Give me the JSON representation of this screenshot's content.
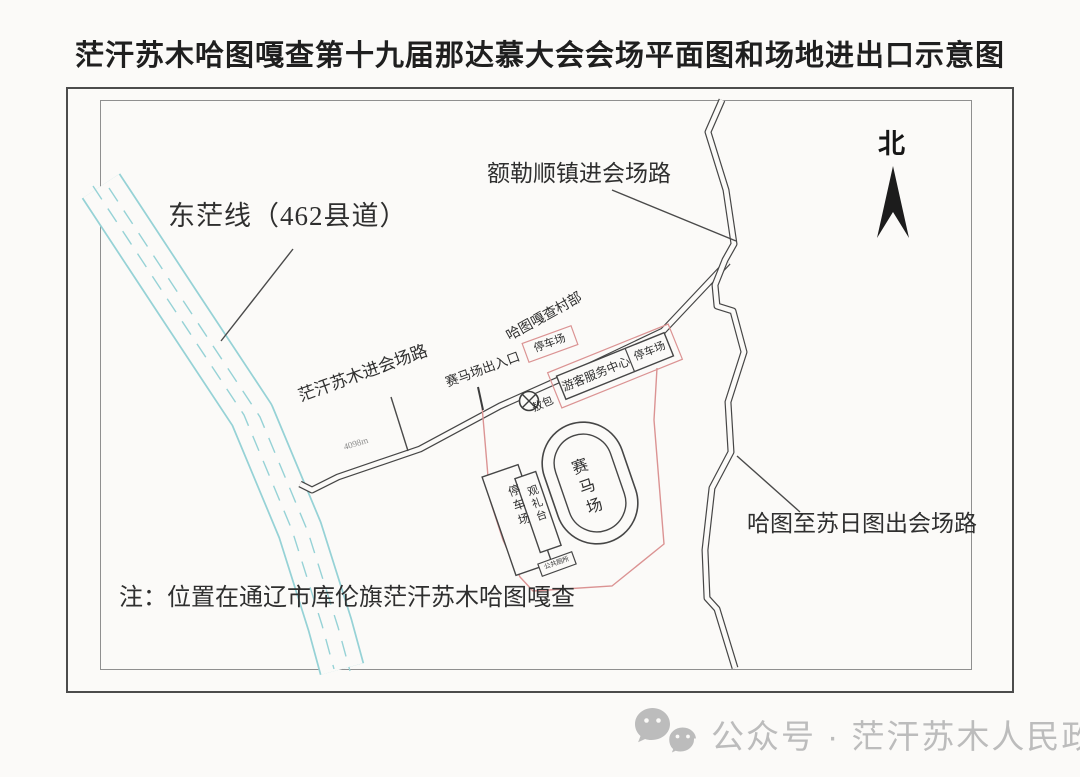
{
  "title": "茫汗苏木哈图嘎查第十九届那达慕大会会场平面图和场地进出口示意图",
  "map": {
    "north": "北",
    "roads": {
      "county_road_label": "东茫线（462县道）",
      "eleshun_entry_label": "额勒顺镇进会场路",
      "manghan_entry_label": "茫汗苏木进会场路",
      "hatu_surit_exit_label": "哈图至苏日图出会场路",
      "distance_marker": "4098m"
    },
    "venue": {
      "village_office": "哈图嘎查村部",
      "parking_north": "停车场",
      "visitor_center": "游客服务中心",
      "visitor_center_parking": "停车场",
      "racecourse_gate": "赛马场出入口",
      "aobao": "敖包",
      "racecourse": "赛马场",
      "viewing_stand": "观礼台",
      "parking_west": "停车场",
      "public_toilet": "公共厕所"
    },
    "note": "注：位置在通辽市库伦旗茫汗苏木哈图嘎查"
  },
  "footer": {
    "text": "公众号 · 茫汗苏木人民政府"
  },
  "colors": {
    "road_cyan": "#96d2d6",
    "boundary_red": "#db9393",
    "ink": "#464646",
    "watermark_gray": "#bcbcbc"
  }
}
